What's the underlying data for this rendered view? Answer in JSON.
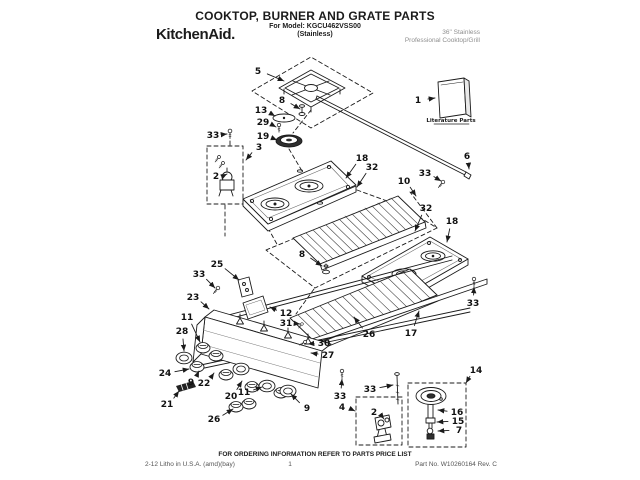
{
  "header": {
    "title": "COOKTOP, BURNER AND GRATE PARTS",
    "model": "For Model: KGCU462VSS00",
    "finish": "(Stainless)",
    "brand": "KitchenAid.",
    "product": [
      "36\" Stainless",
      "Professional Cooktop/Grill"
    ]
  },
  "diagram": {
    "literature_label": "Literature Parts",
    "callouts": [
      {
        "label": "5",
        "x": 258,
        "y": 71,
        "tx": 284,
        "ty": 81
      },
      {
        "label": "8",
        "x": 282,
        "y": 100,
        "tx": 300,
        "ty": 109
      },
      {
        "label": "13",
        "x": 261,
        "y": 110,
        "tx": 275,
        "ty": 116
      },
      {
        "label": "29",
        "x": 263,
        "y": 122,
        "tx": 276,
        "ty": 127
      },
      {
        "label": "19",
        "x": 263,
        "y": 136,
        "tx": 277,
        "ty": 140
      },
      {
        "label": "3",
        "x": 259,
        "y": 147,
        "tx": 246,
        "ty": 160
      },
      {
        "label": "33",
        "x": 213,
        "y": 135,
        "tx": 227,
        "ty": 134
      },
      {
        "label": "2",
        "x": 216,
        "y": 176,
        "tx": 227,
        "ty": 174
      },
      {
        "label": "1",
        "x": 418,
        "y": 100,
        "tx": 435,
        "ty": 98
      },
      {
        "label": "6",
        "x": 467,
        "y": 156,
        "tx": 469,
        "ty": 169
      },
      {
        "label": "33",
        "x": 425,
        "y": 173,
        "tx": 441,
        "ty": 181
      },
      {
        "label": "18",
        "x": 362,
        "y": 158,
        "tx": 346,
        "ty": 178
      },
      {
        "label": "32",
        "x": 372,
        "y": 167,
        "tx": 357,
        "ty": 187
      },
      {
        "label": "10",
        "x": 404,
        "y": 181,
        "tx": 416,
        "ty": 196
      },
      {
        "label": "32",
        "x": 426,
        "y": 208,
        "tx": 415,
        "ty": 231
      },
      {
        "label": "18",
        "x": 452,
        "y": 221,
        "tx": 447,
        "ty": 242
      },
      {
        "label": "8",
        "x": 302,
        "y": 254,
        "tx": 322,
        "ty": 266
      },
      {
        "label": "26",
        "x": 369,
        "y": 334,
        "tx": 354,
        "ty": 317
      },
      {
        "label": "17",
        "x": 411,
        "y": 333,
        "tx": 419,
        "ty": 311
      },
      {
        "label": "33",
        "x": 473,
        "y": 303,
        "tx": 474,
        "ty": 287
      },
      {
        "label": "25",
        "x": 217,
        "y": 264,
        "tx": 239,
        "ty": 280
      },
      {
        "label": "33",
        "x": 199,
        "y": 274,
        "tx": 215,
        "ty": 288
      },
      {
        "label": "23",
        "x": 193,
        "y": 297,
        "tx": 209,
        "ty": 309
      },
      {
        "label": "12",
        "x": 286,
        "y": 313,
        "tx": 270,
        "ty": 307
      },
      {
        "label": "31",
        "x": 286,
        "y": 323,
        "tx": 300,
        "ty": 324
      },
      {
        "label": "30",
        "x": 324,
        "y": 343,
        "tx": 308,
        "ty": 344
      },
      {
        "label": "27",
        "x": 328,
        "y": 355,
        "tx": 311,
        "ty": 353
      },
      {
        "label": "11",
        "x": 187,
        "y": 317,
        "tx": 200,
        "ty": 342
      },
      {
        "label": "28",
        "x": 182,
        "y": 331,
        "tx": 184,
        "ty": 351
      },
      {
        "label": "24",
        "x": 165,
        "y": 373,
        "tx": 189,
        "ty": 369
      },
      {
        "label": "9",
        "x": 191,
        "y": 382,
        "tx": 199,
        "ty": 371
      },
      {
        "label": "22",
        "x": 204,
        "y": 383,
        "tx": 214,
        "ty": 373
      },
      {
        "label": "21",
        "x": 167,
        "y": 404,
        "tx": 179,
        "ty": 391
      },
      {
        "label": "20",
        "x": 231,
        "y": 396,
        "tx": 242,
        "ty": 381
      },
      {
        "label": "11",
        "x": 244,
        "y": 392,
        "tx": 262,
        "ty": 387
      },
      {
        "label": "26",
        "x": 214,
        "y": 419,
        "tx": 233,
        "ty": 409
      },
      {
        "label": "9",
        "x": 307,
        "y": 408,
        "tx": 291,
        "ty": 394
      },
      {
        "label": "33",
        "x": 340,
        "y": 396,
        "tx": 342,
        "ty": 379
      },
      {
        "label": "4",
        "x": 342,
        "y": 407,
        "tx": 355,
        "ty": 411
      },
      {
        "label": "2",
        "x": 374,
        "y": 412,
        "tx": 384,
        "ty": 419
      },
      {
        "label": "33",
        "x": 370,
        "y": 389,
        "tx": 393,
        "ty": 385
      },
      {
        "label": "14",
        "x": 476,
        "y": 370,
        "tx": 466,
        "ty": 383
      },
      {
        "label": "16",
        "x": 457,
        "y": 412,
        "tx": 438,
        "ty": 410
      },
      {
        "label": "15",
        "x": 458,
        "y": 421,
        "tx": 437,
        "ty": 422
      },
      {
        "label": "7",
        "x": 459,
        "y": 430,
        "tx": 438,
        "ty": 431
      }
    ]
  },
  "footer": {
    "ordering_note": "FOR ORDERING INFORMATION REFER TO PARTS PRICE LIST",
    "litho": "2-12 Litho in U.S.A. (amd)(bay)",
    "page_number": "1",
    "part_no": "Part No. W10260164 Rev. C"
  }
}
